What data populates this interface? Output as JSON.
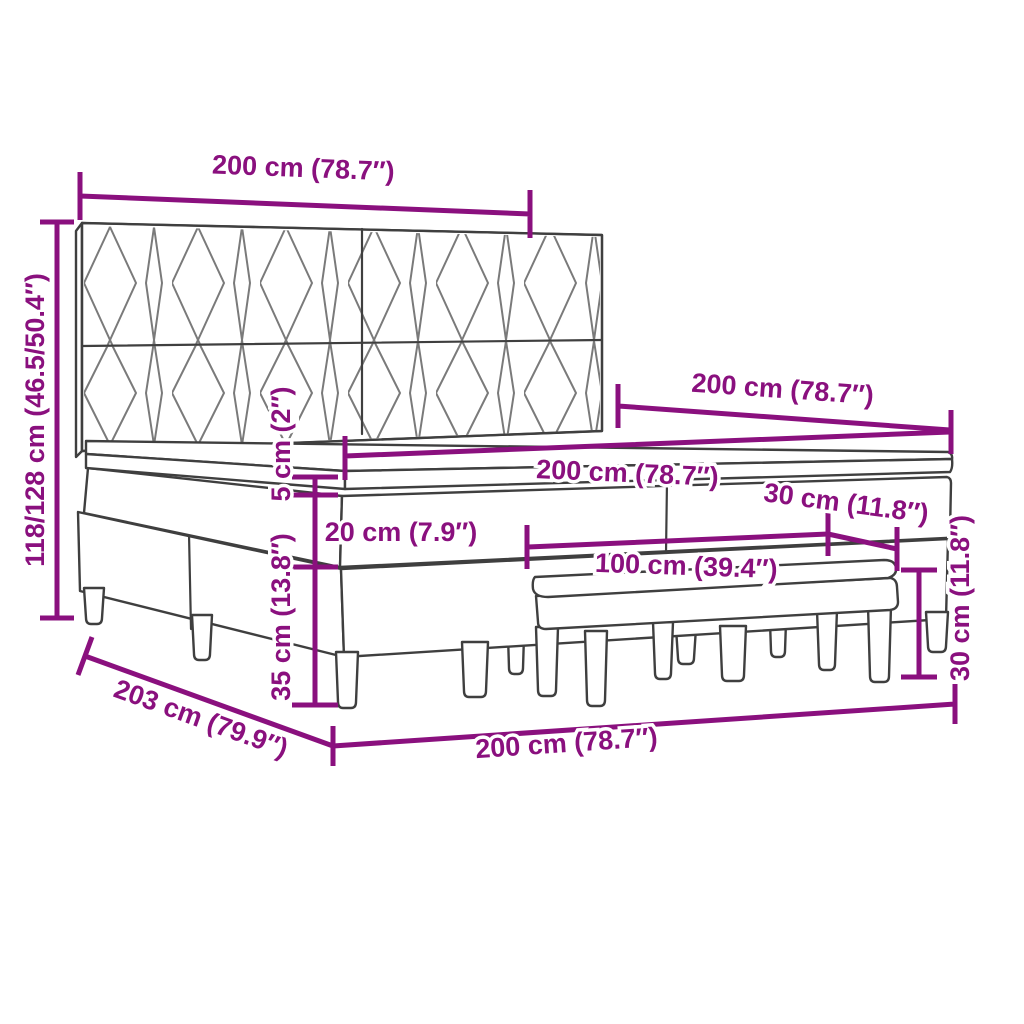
{
  "diagram": {
    "kind": "furniture-dimension-diagram",
    "subject": "box-spring-bed-with-headboard-and-bench",
    "colors": {
      "dimension_accent": "#8A107E",
      "outline": "#3F3F3F",
      "pattern_line": "#7A7A7A",
      "background": "#FFFFFF"
    },
    "labels": {
      "width_top": "200 cm (78.7″)",
      "height_total": "118/128 cm (46.5/50.4″)",
      "length_top": "200 cm (78.7″)",
      "mattress_width": "200 cm (78.7″)",
      "mattress_thickness": "5 cm (2″)",
      "upper_box_height": "20 cm (7.9″)",
      "base_height": "35 cm (13.8″)",
      "bench_length": "100 cm (39.4″)",
      "bench_depth": "30 cm (11.8″)",
      "bench_height": "30 cm (11.8″)",
      "frame_depth": "203 cm (79.9″)",
      "width_bottom": "200 cm (78.7″)"
    }
  }
}
